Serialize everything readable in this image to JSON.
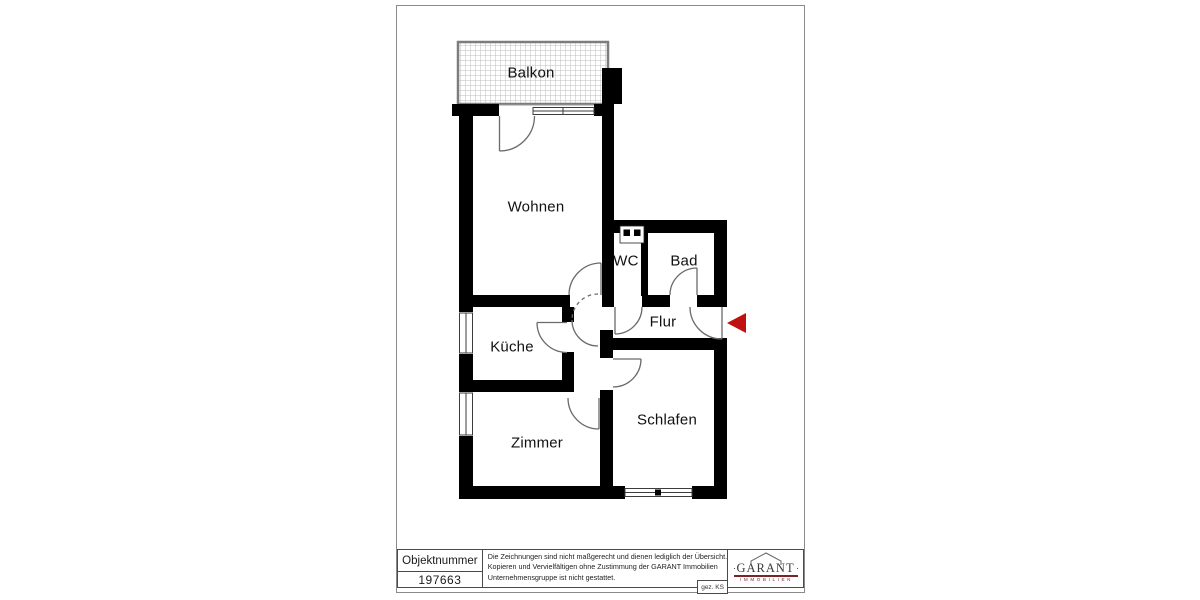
{
  "floorplan": {
    "rooms": [
      {
        "id": "balkon",
        "label": "Balkon"
      },
      {
        "id": "wohnen",
        "label": "Wohnen"
      },
      {
        "id": "wc",
        "label": "WC"
      },
      {
        "id": "bad",
        "label": "Bad"
      },
      {
        "id": "flur",
        "label": "Flur"
      },
      {
        "id": "kueche",
        "label": "Küche"
      },
      {
        "id": "zimmer",
        "label": "Zimmer"
      },
      {
        "id": "schlafen",
        "label": "Schlafen"
      }
    ],
    "entrance_arrow_color": "#c01111"
  },
  "title_block": {
    "object_number_label": "Objektnummer",
    "object_number_value": "197663",
    "disclaimer_lines": [
      "Die Zeichnungen sind nicht maßgerecht und dienen lediglich der Übersicht.",
      "Kopieren und Vervielfältigen ohne Zustimmung der GARANT Immobilien",
      "Unternehmensgruppe ist nicht gestattet."
    ],
    "signature": "gez. KS",
    "logo": {
      "name": "GARANT",
      "subtitle": "IMMOBILIEN",
      "accent_color": "#7a2427"
    }
  }
}
